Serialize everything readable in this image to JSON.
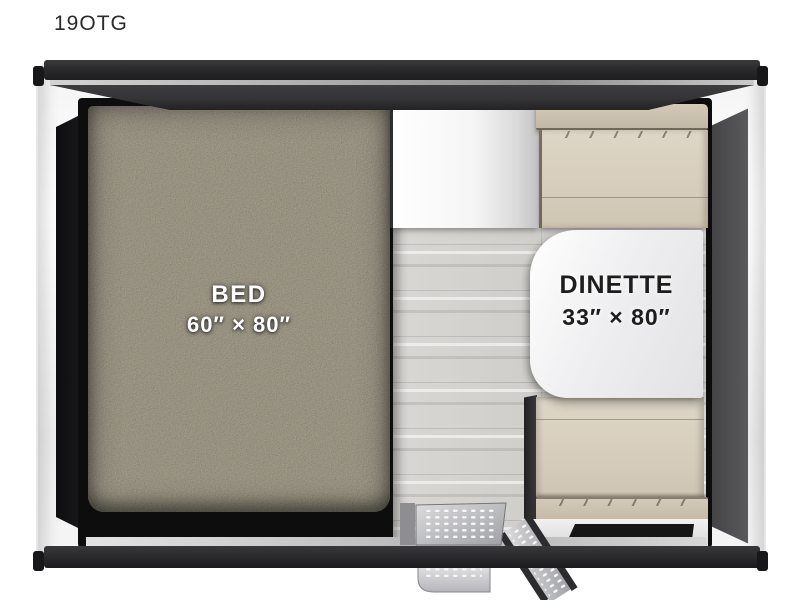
{
  "title": "19OTG",
  "floorplan": {
    "bed": {
      "label": "BED",
      "dimensions": "60″ × 80″"
    },
    "dinette": {
      "label": "DINETTE",
      "dimensions": "33″ × 80″"
    }
  },
  "colors": {
    "roof_bar": "#2a2a2c",
    "roof_band": "#343436",
    "bed_surface": "#6f6b62",
    "cushion": "#d6cdbc",
    "cushion_trim": "#c2b8a5",
    "table": "#efeff1",
    "floor": "#d3d2cf",
    "wall_panel_dark": "#434345",
    "step_metal": "#c9c9cc"
  }
}
